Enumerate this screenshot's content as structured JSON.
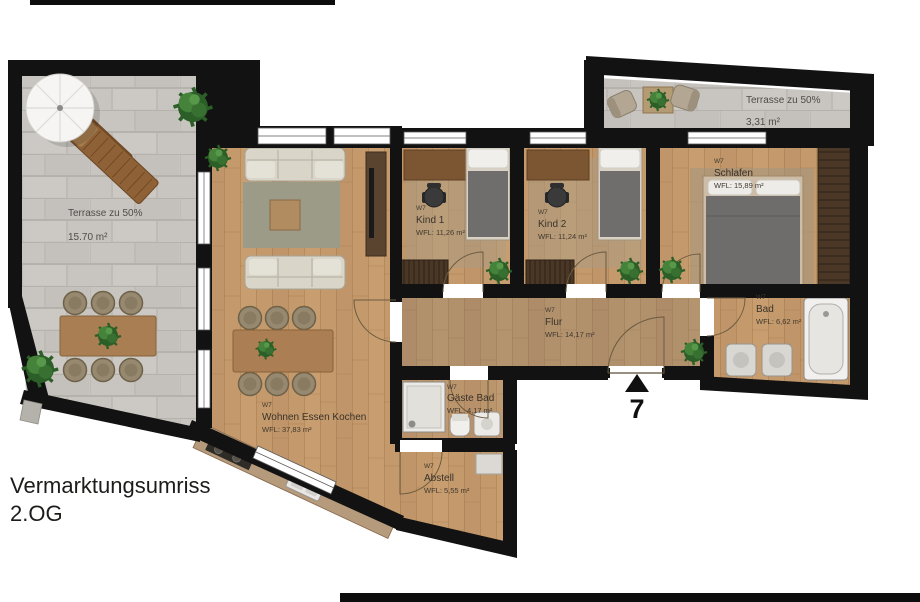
{
  "plan": {
    "title_line1": "Vermarktungsumriss",
    "title_line2": "2.OG",
    "unit_code": "W7",
    "entrance_number": "7"
  },
  "rooms": {
    "terrasse_links": {
      "name": "Terrasse zu 50%",
      "area": "15.70 m²"
    },
    "terrasse_rechts": {
      "name": "Terrasse zu 50%",
      "area": "3,31 m²"
    },
    "wohnen": {
      "unit": "W7",
      "name": "Wohnen Essen Kochen",
      "area": "WFL: 37,83 m²"
    },
    "kind1": {
      "unit": "W7",
      "name": "Kind 1",
      "area": "WFL: 11,26 m²"
    },
    "kind2": {
      "unit": "W7",
      "name": "Kind 2",
      "area": "WFL: 11,24 m²"
    },
    "schlafen": {
      "unit": "W7",
      "name": "Schlafen",
      "area": "WFL: 15,89 m²"
    },
    "bad": {
      "unit": "W7",
      "name": "Bad",
      "area": "WFL: 6,62 m²"
    },
    "flur": {
      "unit": "W7",
      "name": "Flur",
      "area": "WFL: 14,17 m²"
    },
    "gaeste_bad": {
      "unit": "W7",
      "name": "Gäste Bad",
      "area": "WFL: 4,17 m²"
    },
    "abstell": {
      "unit": "W7",
      "name": "Abstell",
      "area": "WFL: 5,55 m²"
    }
  },
  "colors": {
    "wall": "#121212",
    "wood_floor": "#c49a6c",
    "stone_tile": "#c8c5c0",
    "background": "#ffffff"
  }
}
